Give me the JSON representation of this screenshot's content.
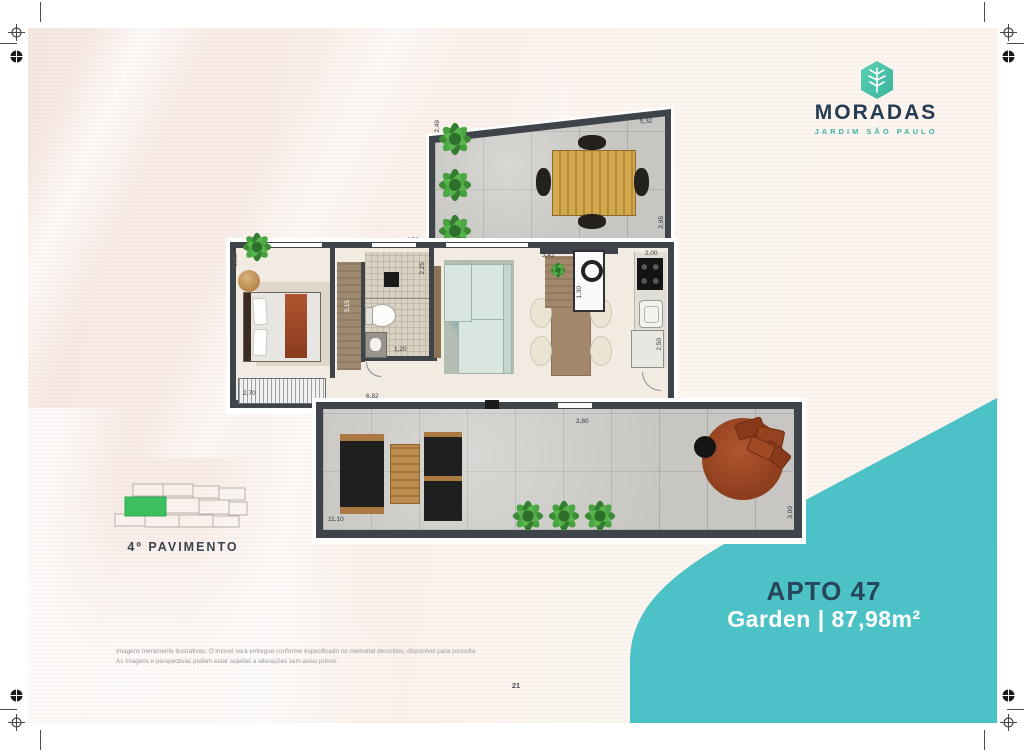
{
  "page": {
    "number": "21"
  },
  "logo": {
    "brand": "MORADAS",
    "subtitle": "JARDIM SÃO PAULO",
    "icon_color": "#4cc7af",
    "brand_color": "#243c51"
  },
  "unit_panel": {
    "title": "APTO 47",
    "subtitle": "Garden | 87,98m²",
    "panel_color": "#4dc2c6",
    "title_color": "#26465b"
  },
  "floor_indicator": {
    "label": "4º PAVIMENTO",
    "highlight_color": "#3cc060"
  },
  "disclaimer": {
    "line1": "Imagens meramente ilustrativas. O imóvel será entregue conforme especificado no memorial descritivo, disponível para consulta.",
    "line2": "As imagens e perspectivas podem estar sujeitas a alterações sem aviso prévio."
  },
  "floorplan": {
    "dimensions": {
      "upper_top": "5,32",
      "upper_right": "2,95",
      "upper_left": "2,49",
      "upper_bottom": "4,52",
      "bedroom_left": "0,93",
      "closet": "3,15",
      "bath_top": "2,25",
      "bath_width": "1,20",
      "bedroom_window": "2,70",
      "living_bottom": "6,82",
      "peninsula": "3,42",
      "laundry": "1,30",
      "kitchen_top": "2,00",
      "kitchen_bottom": "2,50",
      "terrace_bottom": "11,10",
      "terrace_top": "2,80",
      "terrace_right": "3,00"
    }
  }
}
